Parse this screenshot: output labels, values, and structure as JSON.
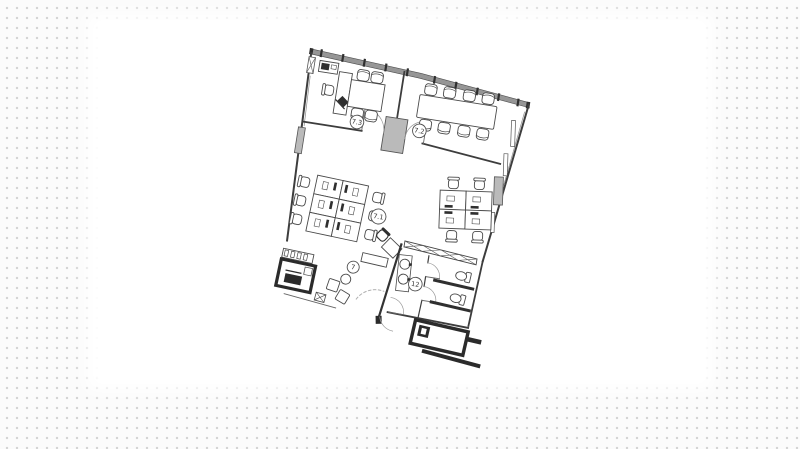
{
  "background": {
    "canvas_color": "#fbfbfb",
    "dot_color": "#d4d4d4",
    "page_color": "#ffffff"
  },
  "floor_plan": {
    "labels": {
      "room_7_3": "7.3",
      "room_7_2": "7.2",
      "room_7_1": "7.1",
      "zone_7": "7",
      "room_12": "12"
    },
    "colors": {
      "wall": "#3d3d3d",
      "furniture_line": "#4a4a4a",
      "column_fill": "#bababa",
      "facade_fill": "#969696",
      "dark_fill": "#2b2b2b",
      "door_arc": "#999999"
    }
  }
}
